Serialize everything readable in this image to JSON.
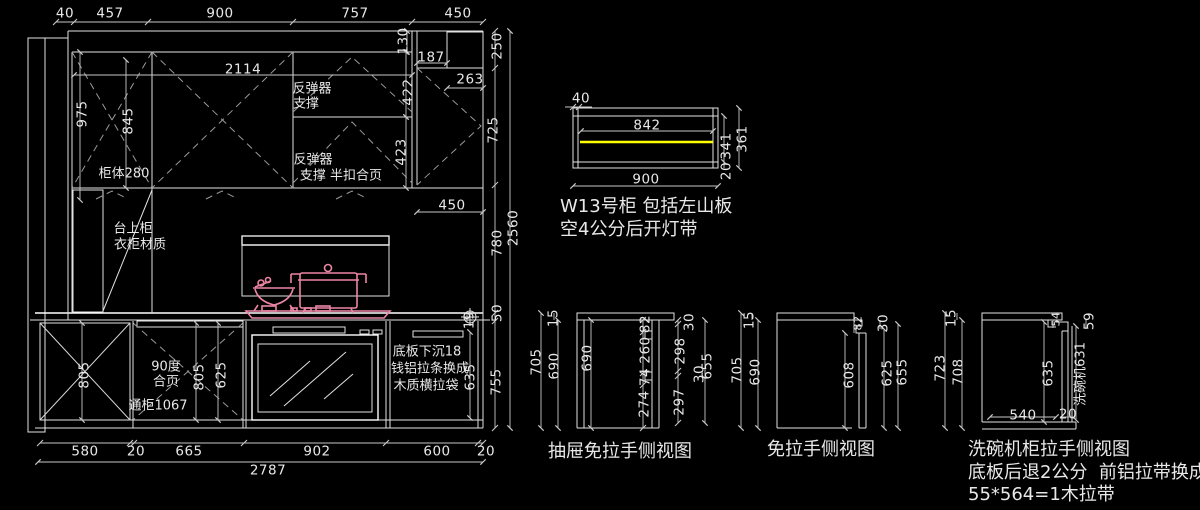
{
  "drawing": {
    "kind": "kitchen-cabinet-elevation-cad",
    "palette": {
      "background": "#000000",
      "line": "#e2e2e2",
      "dimension": "#c8c8c8",
      "dashed": "#9a9a9a",
      "cookware_pink": "#ed85a5",
      "light_strip_yellow": "#ffff00"
    },
    "labels": [
      {
        "g": "dim",
        "t": "40",
        "x": 65,
        "y": 14
      },
      {
        "g": "dim",
        "t": "457",
        "x": 110,
        "y": 14
      },
      {
        "g": "dim",
        "t": "900",
        "x": 220,
        "y": 14
      },
      {
        "g": "dim",
        "t": "757",
        "x": 355,
        "y": 14
      },
      {
        "g": "dim",
        "t": "450",
        "x": 458,
        "y": 14
      },
      {
        "g": "dim",
        "t": "2114",
        "x": 243,
        "y": 70
      },
      {
        "g": "dim",
        "t": "130",
        "x": 404,
        "y": 41,
        "r": -90
      },
      {
        "g": "dim",
        "t": "187",
        "x": 431,
        "y": 58
      },
      {
        "g": "dim",
        "t": "250",
        "x": 498,
        "y": 46,
        "r": -90
      },
      {
        "g": "dim",
        "t": "263",
        "x": 470,
        "y": 80
      },
      {
        "g": "dim",
        "t": "422",
        "x": 409,
        "y": 92,
        "r": -90
      },
      {
        "g": "note",
        "t": "反弹器",
        "x": 312,
        "y": 89
      },
      {
        "g": "note",
        "t": "支撑",
        "x": 306,
        "y": 104
      },
      {
        "g": "dim",
        "t": "975",
        "x": 83,
        "y": 114,
        "r": -90
      },
      {
        "g": "dim",
        "t": "845",
        "x": 129,
        "y": 121,
        "r": -90
      },
      {
        "g": "dim",
        "t": "725",
        "x": 494,
        "y": 130,
        "r": -90
      },
      {
        "g": "note",
        "t": "反弹器",
        "x": 313,
        "y": 160
      },
      {
        "g": "note",
        "t": "支撑 半扣合页",
        "x": 341,
        "y": 176
      },
      {
        "g": "dim",
        "t": "423",
        "x": 402,
        "y": 152,
        "r": -90
      },
      {
        "g": "note",
        "t": "柜体280",
        "x": 124,
        "y": 174
      },
      {
        "g": "dim",
        "t": "450",
        "x": 452,
        "y": 206
      },
      {
        "g": "note",
        "t": "台上柜",
        "x": 133,
        "y": 229
      },
      {
        "g": "note",
        "t": "衣柜材质",
        "x": 140,
        "y": 245
      },
      {
        "g": "dim",
        "t": "780",
        "x": 498,
        "y": 243,
        "r": -90
      },
      {
        "g": "dim",
        "t": "2560",
        "x": 514,
        "y": 228,
        "r": -90
      },
      {
        "g": "dim",
        "t": "50",
        "x": 498,
        "y": 313,
        "r": -90
      },
      {
        "g": "dim",
        "t": "19",
        "x": 470,
        "y": 320,
        "r": -90
      },
      {
        "g": "dim",
        "t": "805",
        "x": 85,
        "y": 375,
        "r": -90
      },
      {
        "g": "note",
        "t": "90度",
        "x": 166,
        "y": 367
      },
      {
        "g": "note",
        "t": "合页",
        "x": 166,
        "y": 382
      },
      {
        "g": "dim",
        "t": "805",
        "x": 200,
        "y": 377,
        "r": -90
      },
      {
        "g": "dim",
        "t": "625",
        "x": 222,
        "y": 375,
        "r": -90
      },
      {
        "g": "note",
        "t": "通柜1067",
        "x": 158,
        "y": 406
      },
      {
        "g": "note",
        "t": "底板下沉18",
        "x": 427,
        "y": 352
      },
      {
        "g": "note",
        "t": "钱铝拉条换成",
        "x": 430,
        "y": 369
      },
      {
        "g": "note",
        "t": "木质横拉袋",
        "x": 426,
        "y": 386
      },
      {
        "g": "dim",
        "t": "635",
        "x": 471,
        "y": 377,
        "r": -90
      },
      {
        "g": "dim",
        "t": "755",
        "x": 497,
        "y": 382,
        "r": -90
      },
      {
        "g": "dim",
        "t": "580",
        "x": 85,
        "y": 452
      },
      {
        "g": "dim",
        "t": "20",
        "x": 136,
        "y": 452
      },
      {
        "g": "dim",
        "t": "665",
        "x": 189,
        "y": 452
      },
      {
        "g": "dim",
        "t": "902",
        "x": 317,
        "y": 452
      },
      {
        "g": "dim",
        "t": "600",
        "x": 437,
        "y": 452
      },
      {
        "g": "dim",
        "t": "20",
        "x": 486,
        "y": 452
      },
      {
        "g": "dim",
        "t": "2787",
        "x": 268,
        "y": 471
      },
      {
        "g": "dim",
        "t": "40",
        "x": 581,
        "y": 99
      },
      {
        "g": "dim",
        "t": "842",
        "x": 647,
        "y": 126
      },
      {
        "g": "dim",
        "t": "341",
        "x": 727,
        "y": 146,
        "r": -90
      },
      {
        "g": "dim",
        "t": "361",
        "x": 743,
        "y": 139,
        "r": -90
      },
      {
        "g": "dim",
        "t": "20",
        "x": 727,
        "y": 171,
        "r": -90
      },
      {
        "g": "dim",
        "t": "900",
        "x": 646,
        "y": 180
      },
      {
        "g": "title",
        "t": "W13号柜 包括左山板",
        "x": 560,
        "y": 207,
        "a": "l"
      },
      {
        "g": "title",
        "t": "空4公分后开灯带",
        "x": 560,
        "y": 230,
        "a": "l"
      },
      {
        "g": "dim",
        "t": "15",
        "x": 554,
        "y": 318,
        "r": -90
      },
      {
        "g": "dim",
        "t": "705",
        "x": 537,
        "y": 362,
        "r": -90
      },
      {
        "g": "dim",
        "t": "690",
        "x": 555,
        "y": 366,
        "r": -90
      },
      {
        "g": "dim",
        "t": "690",
        "x": 588,
        "y": 358,
        "r": -90
      },
      {
        "g": "dim",
        "t": "82",
        "x": 646,
        "y": 324,
        "r": -90
      },
      {
        "g": "dim",
        "t": "260",
        "x": 646,
        "y": 350,
        "r": -90
      },
      {
        "g": "dim",
        "t": "74",
        "x": 646,
        "y": 377,
        "r": -90
      },
      {
        "g": "dim",
        "t": "274",
        "x": 645,
        "y": 404,
        "r": -90
      },
      {
        "g": "dim",
        "t": "30",
        "x": 690,
        "y": 322,
        "r": -90
      },
      {
        "g": "dim",
        "t": "298",
        "x": 681,
        "y": 351,
        "r": -90
      },
      {
        "g": "dim",
        "t": "30",
        "x": 700,
        "y": 374,
        "r": -90
      },
      {
        "g": "dim",
        "t": "297",
        "x": 680,
        "y": 402,
        "r": -90
      },
      {
        "g": "dim",
        "t": "655",
        "x": 708,
        "y": 366,
        "r": -90
      },
      {
        "g": "title",
        "t": "抽屉免拉手侧视图",
        "x": 548,
        "y": 452,
        "a": "l"
      },
      {
        "g": "dim",
        "t": "15",
        "x": 750,
        "y": 320,
        "r": -90
      },
      {
        "g": "dim",
        "t": "705",
        "x": 738,
        "y": 370,
        "r": -90
      },
      {
        "g": "dim",
        "t": "690",
        "x": 756,
        "y": 372,
        "r": -90
      },
      {
        "g": "dim",
        "t": "82",
        "x": 858,
        "y": 323,
        "r": -90,
        "sz": 11
      },
      {
        "g": "dim",
        "t": "608",
        "x": 850,
        "y": 375,
        "r": -90
      },
      {
        "g": "dim",
        "t": "30",
        "x": 884,
        "y": 323,
        "r": -90
      },
      {
        "g": "dim",
        "t": "625",
        "x": 888,
        "y": 373,
        "r": -90
      },
      {
        "g": "dim",
        "t": "655",
        "x": 903,
        "y": 372,
        "r": -90
      },
      {
        "g": "title",
        "t": "免拉手侧视图",
        "x": 767,
        "y": 450,
        "a": "l"
      },
      {
        "g": "dim",
        "t": "15",
        "x": 952,
        "y": 318,
        "r": -90
      },
      {
        "g": "dim",
        "t": "723",
        "x": 941,
        "y": 368,
        "r": -90
      },
      {
        "g": "dim",
        "t": "708",
        "x": 959,
        "y": 372,
        "r": -90
      },
      {
        "g": "dim",
        "t": "54",
        "x": 1056,
        "y": 319,
        "r": -90,
        "sz": 11
      },
      {
        "g": "dim",
        "t": "59",
        "x": 1090,
        "y": 321,
        "r": -90
      },
      {
        "g": "dim",
        "t": "635",
        "x": 1049,
        "y": 373,
        "r": -90
      },
      {
        "g": "note",
        "t": "洗碗机631",
        "x": 1081,
        "y": 374,
        "r": -90
      },
      {
        "g": "dim",
        "t": "540",
        "x": 1023,
        "y": 416
      },
      {
        "g": "dim",
        "t": "20",
        "x": 1068,
        "y": 415
      },
      {
        "g": "title",
        "t": "洗碗机柜拉手侧视图",
        "x": 968,
        "y": 450,
        "a": "l"
      },
      {
        "g": "title",
        "t": "底板后退2公分  前铝拉带换成",
        "x": 968,
        "y": 473,
        "a": "l"
      },
      {
        "g": "title",
        "t": "55*564=1木拉带",
        "x": 968,
        "y": 495,
        "a": "l"
      }
    ]
  }
}
